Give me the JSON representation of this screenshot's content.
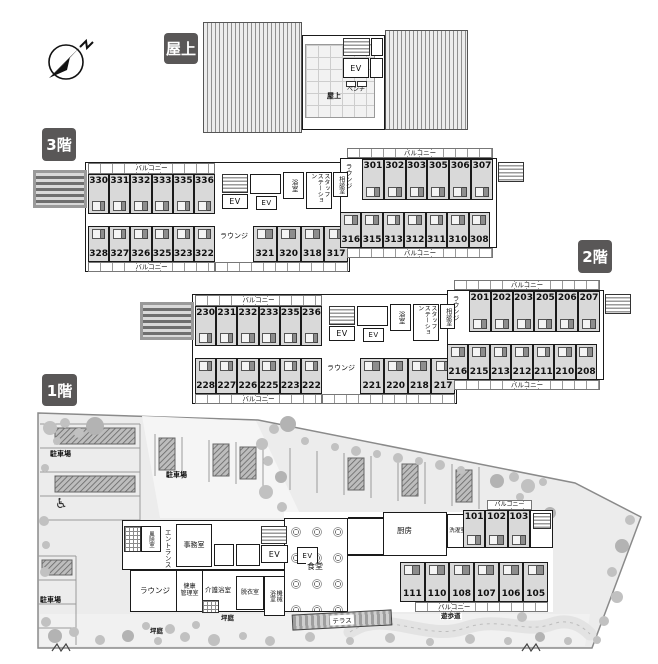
{
  "badges": {
    "rooftop": "屋上",
    "floor3": "3階",
    "floor2": "2階",
    "floor1": "1階"
  },
  "labels": {
    "balcony": "バルコニー",
    "lounge": "ラウンジ",
    "ev": "EV",
    "bath": "浴室",
    "staff_station": "スタッフ\nステーション",
    "consult_room": "相談室",
    "bench": "ベンチ",
    "rooftop_deck": "屋上",
    "windbreak_room": "風除室",
    "entrance": "エントランス",
    "office": "事務室",
    "health_admin_room": "健康\n管理室",
    "care_bath": "介護浴室",
    "dressing_room": "脱衣室",
    "machine_bath": "機械\n浴室",
    "dining_hall": "食堂",
    "kitchen": "厨房",
    "laundry_room": "洗濯室",
    "terrace": "テラス",
    "promenade": "遊歩道",
    "courtyard_garden": "坪庭",
    "parking": "駐車場",
    "north": "N"
  },
  "icons": {
    "wheelchair": "♿",
    "compass": "north-arrow"
  },
  "floor3": {
    "left_top": [
      "330",
      "331",
      "332",
      "333",
      "335",
      "336"
    ],
    "left_bottom": [
      "328",
      "327",
      "326",
      "325",
      "323",
      "322"
    ],
    "mid_bottom": [
      "321",
      "320",
      "318",
      "317"
    ],
    "right_top": [
      "301",
      "302",
      "303",
      "305",
      "306",
      "307"
    ],
    "right_bottom": [
      "316",
      "315",
      "313",
      "312",
      "311",
      "310",
      "308"
    ]
  },
  "floor2": {
    "left_top": [
      "230",
      "231",
      "232",
      "233",
      "235",
      "236"
    ],
    "left_bottom": [
      "228",
      "227",
      "226",
      "225",
      "223",
      "222"
    ],
    "mid_bottom": [
      "221",
      "220",
      "218",
      "217"
    ],
    "right_top": [
      "201",
      "202",
      "203",
      "205",
      "206",
      "207"
    ],
    "right_bottom": [
      "216",
      "215",
      "213",
      "212",
      "211",
      "210",
      "208"
    ]
  },
  "floor1": {
    "right_top": [
      "101",
      "102",
      "103"
    ],
    "right_bottom": [
      "111",
      "110",
      "108",
      "107",
      "106",
      "105"
    ]
  },
  "colors": {
    "badge_bg": "#595757",
    "room_fill": "#d9d9d9",
    "site_fill": "#ececec",
    "tree_fill": "#c1c1c1",
    "wall": "#1a1a1a"
  }
}
